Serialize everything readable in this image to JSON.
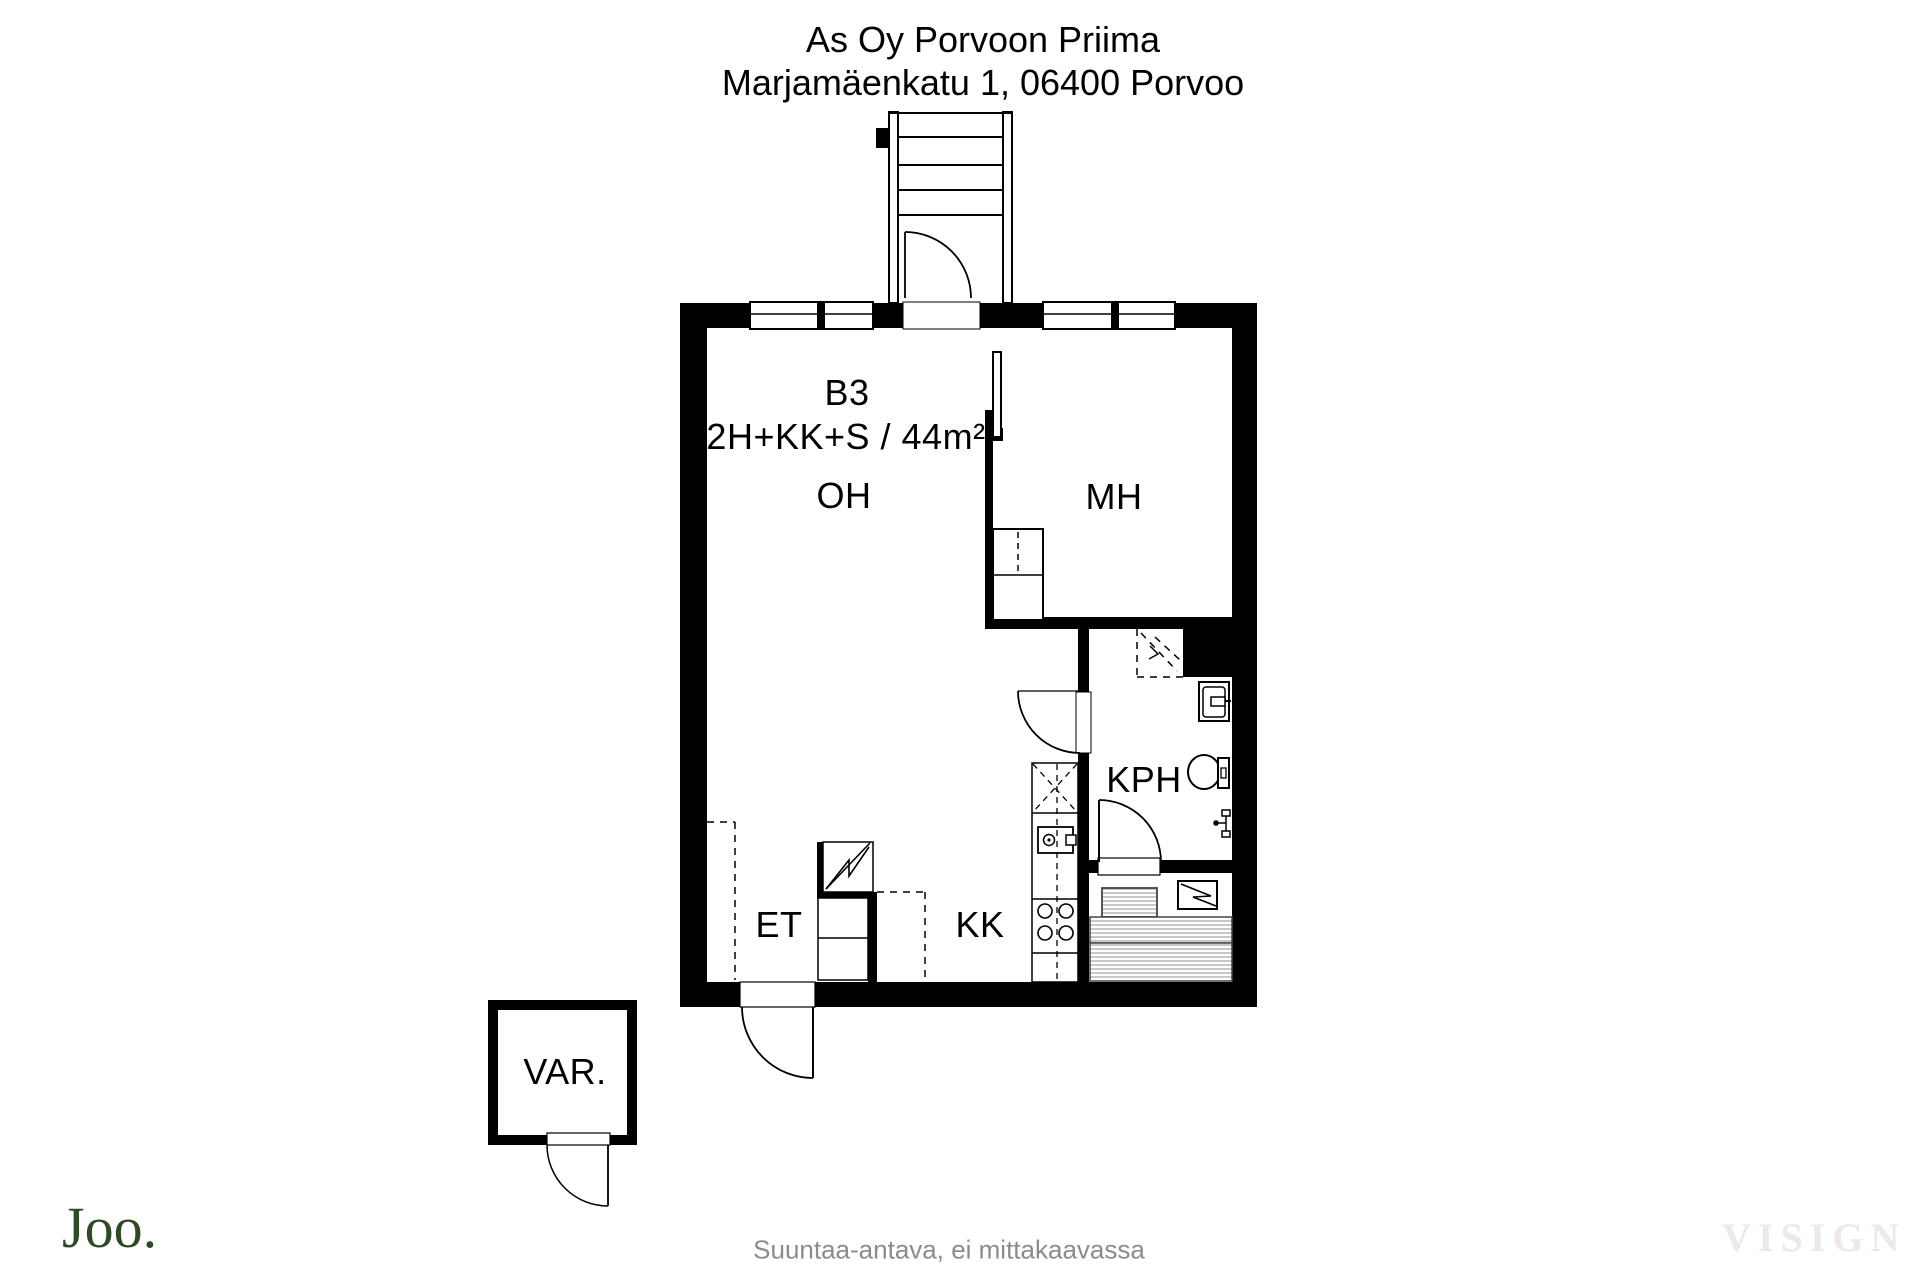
{
  "title": {
    "line1": "As Oy Porvoon Priima",
    "line2": "Marjamäenkatu 1, 06400 Porvoo"
  },
  "unit": {
    "id": "B3",
    "type": "2H+KK+S / 44m²"
  },
  "rooms": {
    "living_room": "OH",
    "bedroom": "MH",
    "bathroom": "KPH",
    "entry": "ET",
    "kitchenette": "KK",
    "storage": "VAR."
  },
  "footer": {
    "note": "Suuntaa-antava, ei mittakaavassa",
    "logo": "Joo.",
    "watermark": "VISIGN"
  },
  "colors": {
    "wall": "#000000",
    "logo_green": "#2e4a25",
    "note_gray": "#8b8b8b",
    "watermark_gray": "#ece9e6",
    "bench_stripe": "#999999"
  }
}
